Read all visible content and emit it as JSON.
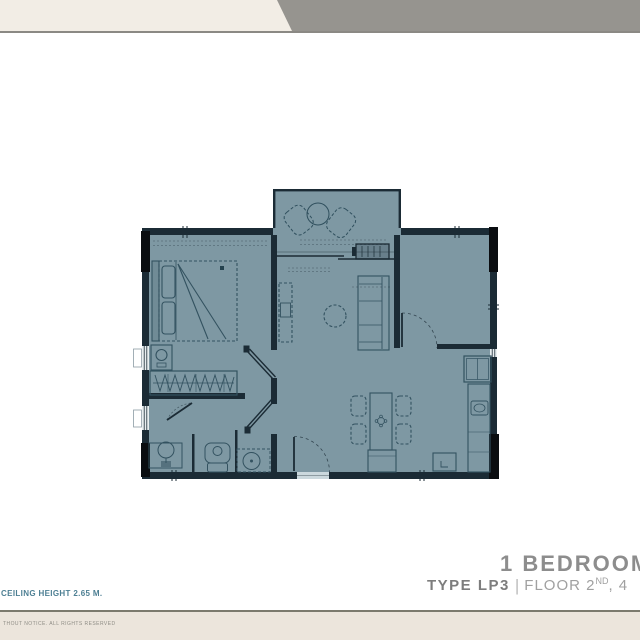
{
  "banner": {
    "left_color": "#F2EDE5",
    "right_color": "#96948F",
    "border_color": "#8B8984"
  },
  "title_block": {
    "title": "1 BEDROOM",
    "type_label": "TYPE LP3",
    "separator": "|",
    "floor_text": "FLOOR 2",
    "floor_superscript": "ND",
    "floor_rest": ", 4"
  },
  "footer": {
    "ceiling_note": "CEILING HEIGHT 2.65 M.",
    "rights_text": "THOUT NOTICE. ALL RIGHTS RESERVED",
    "band_color": "#ECE5DC",
    "line_color": "#7C7A6E",
    "note_color": "#4D7F93",
    "rights_color": "#8F8D86"
  },
  "floorplan": {
    "fill_color": "#7E98A3",
    "wall_color": "#1B2B35",
    "furniture_color": "#335260",
    "column_color": "#0A0D10",
    "features": [
      "balcony",
      "living-room",
      "bedroom",
      "wardrobe",
      "bathroom",
      "kitchen",
      "dining-area",
      "den-room",
      "entrance-door",
      "ac-unit"
    ]
  }
}
